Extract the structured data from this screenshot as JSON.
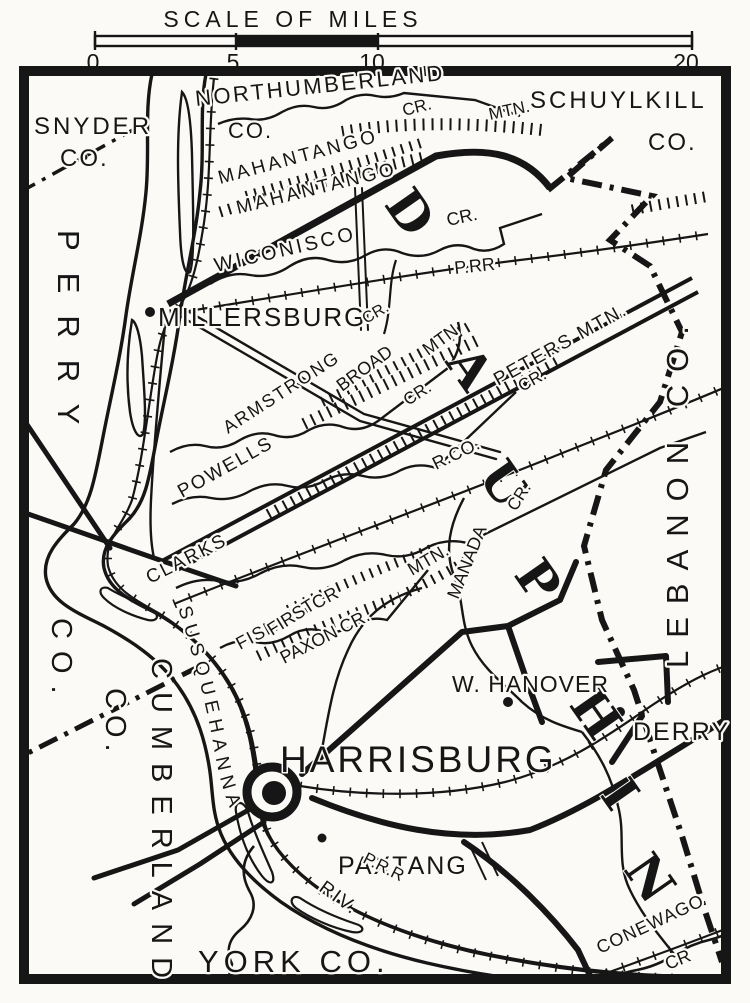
{
  "scale_bar": {
    "title": "SCALE OF MILES",
    "ticks": [
      "0",
      "5",
      "10",
      "20"
    ]
  },
  "counties": {
    "snyder": "SNYDER",
    "snyder_co": "CO.",
    "northumberland": "NORTHUMBERLAND",
    "northumberland_co": "CO.",
    "schuylkill": "SCHUYLKILL",
    "schuylkill_co": "CO.",
    "perry": "PERRY",
    "perry_co": "CO.",
    "lebanon": "LEBANON CO.",
    "cumberland": "CUMBERLAND",
    "cumberland_co": "CO.",
    "york": "YORK CO.",
    "dauphin": "DAUPHIN"
  },
  "towns": {
    "millersburg": "MILLERSBURG",
    "harrisburg": "HARRISBURG",
    "paxtang": "PAXTANG",
    "w_hanover": "W. HANOVER",
    "derry": "DERRY"
  },
  "features": {
    "mahantango_upper": "MAHANTANGO",
    "mahantango_lower": "MAHANTANGO",
    "mahantango_mtn": "MTN.",
    "mahantango_cr": "CR.",
    "wiconisco": "WICONISCO",
    "wiconisco_cr": "CR.",
    "prr_north": "P.RR",
    "armstrong": "ARMSTRONG",
    "armstrong_cr": "CR.",
    "small_cr": "CR.",
    "broad": "BROAD",
    "broad_mtn": "MTN",
    "peters_mtn": "PETERS MTN.",
    "rr_co": "R.CO.",
    "powells": "POWELLS",
    "powells_cr": "CR.",
    "clarks": "CLARKS",
    "fishing_cr": "FISHING CR",
    "first": "FIRST",
    "first_mtn": "MTN.",
    "paxon_cr": "PAXON CR.",
    "manada": "MANADA",
    "manada_cr": "CR.",
    "susquehanna": "SUSQUEHANNA",
    "riv": "RIV.",
    "prr_south": "P.R.R",
    "conewago": "CONEWAGO",
    "conewago_cr": "CR"
  },
  "colors": {
    "ink": "#161616",
    "paper": "#fbfaf6"
  }
}
